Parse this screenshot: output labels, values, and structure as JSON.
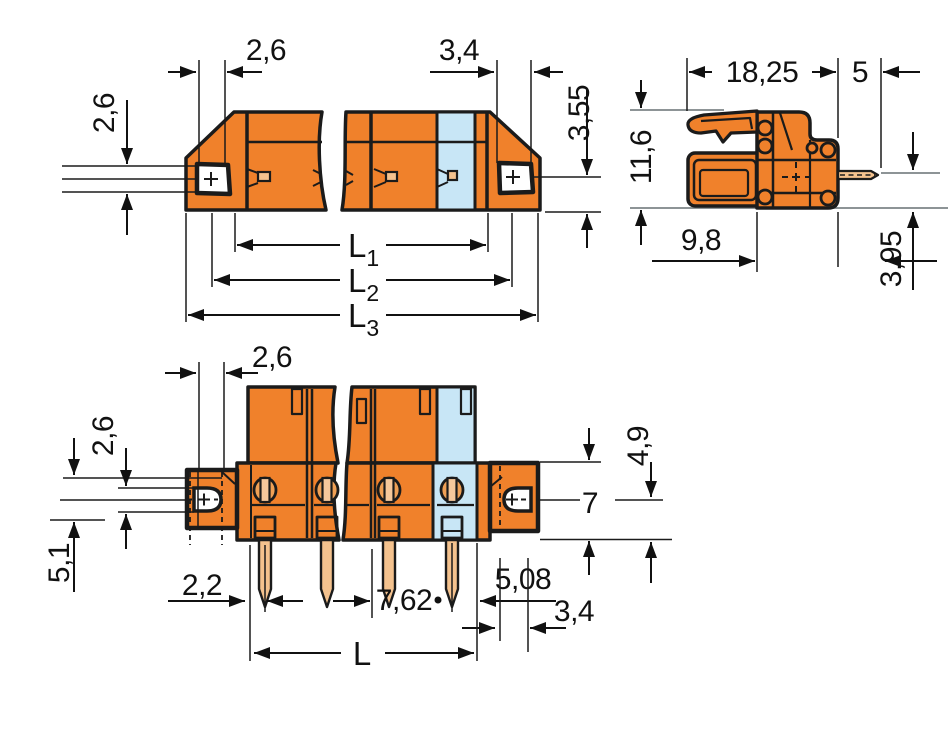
{
  "drawing": {
    "type": "technical-dimension-drawing",
    "views": [
      "front-view-broken",
      "side-view",
      "bottom-view-broken"
    ],
    "colors": {
      "housing_orange": "#F0812B",
      "coding_blue": "#C8E6F6",
      "pin_tan": "#F4C28E",
      "hole_lobe": "#EFA055",
      "hole_bar": "#F6C89B",
      "outline_black": "#1B1B1B",
      "dimension_black": "#111111",
      "reference_gray": "#8D9496",
      "hole_white": "#FFFFFF",
      "background": "#FFFFFF"
    },
    "front": {
      "dims": {
        "hole_height": "2,6",
        "top_width": "2,6",
        "top_width_right": "3,4",
        "side_height": "3,55",
        "l1": {
          "base": "L",
          "sub": "1"
        },
        "l2": {
          "base": "L",
          "sub": "2"
        },
        "l3": {
          "base": "L",
          "sub": "3"
        }
      }
    },
    "side": {
      "dims": {
        "depth": "18,25",
        "pin_length": "5",
        "height": "11,6",
        "lower_depth": "9,8",
        "pin_offset": "3,95"
      }
    },
    "bottom": {
      "dims": {
        "top_width": "2,6",
        "left_offset": "2,6",
        "left_depth": "5,1",
        "edge_offset": "2,2",
        "pin_pitch": "7,62",
        "flange_offset": "5,08",
        "flange_width": "3,4",
        "flange_upper": "4,9",
        "flange_height": "7",
        "total_length": "L"
      }
    }
  }
}
